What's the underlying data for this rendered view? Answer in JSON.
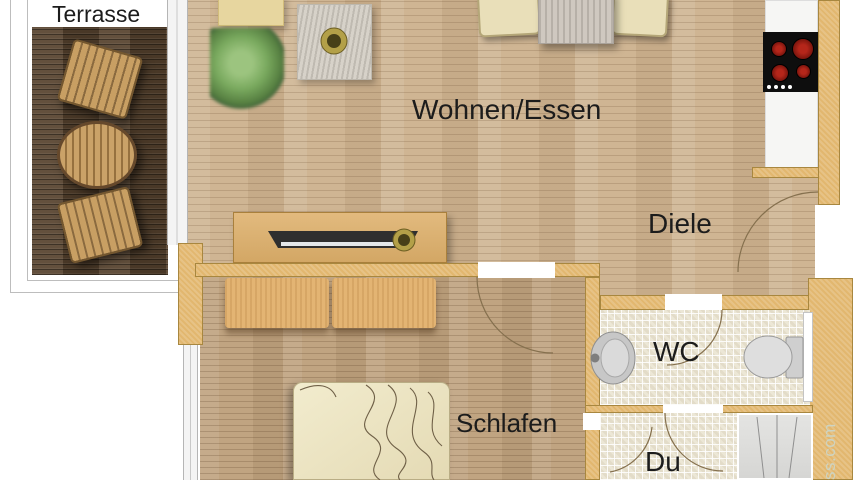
{
  "floorplan": {
    "labels": {
      "terrasse": "Terrasse",
      "wohnen_essen": "Wohnen/Essen",
      "diele": "Diele",
      "wc": "WC",
      "schlafen": "Schlafen",
      "dusche": "Du"
    },
    "watermark": "ss.com",
    "colors": {
      "floor_wood": "#cfb593",
      "floor_wood_dark": "#c0a481",
      "terrace_deck": "#57432e",
      "wall": "#e2b76f",
      "wall_border": "#a8873f",
      "tile": "#ece7d6",
      "counter": "#f6f6f4",
      "cooktop": "#0e0e0e",
      "burner": "#9e1d12",
      "label_text": "#1c1c1c",
      "watermark_text": "#cdd4c3",
      "outside": "#ffffff"
    }
  }
}
